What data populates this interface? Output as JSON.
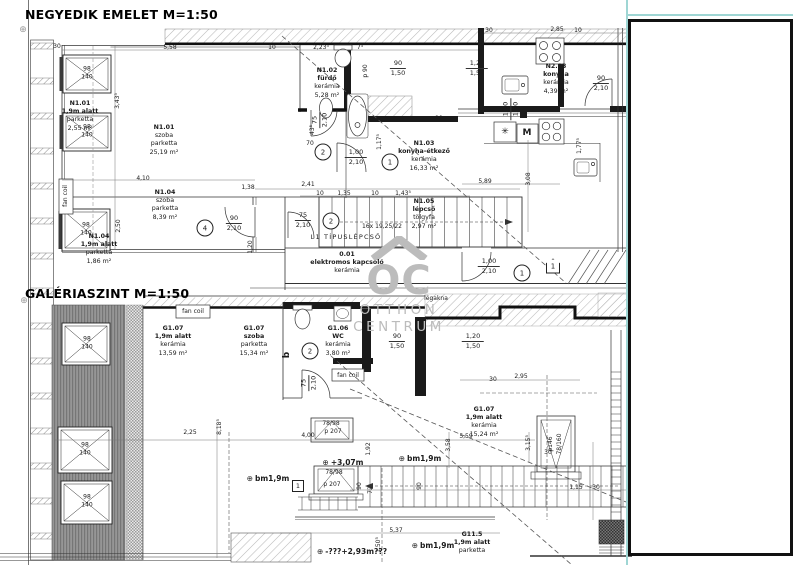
{
  "titles": {
    "upper": "NEGYEDIK EMELET M=1:50",
    "lower": "GALÉRIASZINT M=1:50"
  },
  "watermark": {
    "monogram": "OC",
    "line1": "OTTHON",
    "line2": "CENTRUM"
  },
  "colors": {
    "teal": "#9fd6d4",
    "line": "#1b1b1b",
    "watermark": "#bcbcbc"
  },
  "room_labels": [
    {
      "id": "N1.01",
      "sub": [
        "1,9m alatt",
        "parketta",
        "2,55 m²"
      ],
      "x": 80,
      "y": 100,
      "em": 1
    },
    {
      "id": "N1.01",
      "sub": [
        "szoba",
        "parketta",
        "25,19 m²"
      ],
      "x": 164,
      "y": 124
    },
    {
      "id": "N1.04",
      "sub": [
        "szoba",
        "parketta",
        "8,39 m²"
      ],
      "x": 165,
      "y": 189
    },
    {
      "id": "N1.04",
      "sub": [
        "1,9m alatt",
        "parketta",
        "1,86 m²"
      ],
      "x": 99,
      "y": 233,
      "em": 1
    },
    {
      "id": "N1.02",
      "sub": [
        "fürdő",
        "kerámia",
        "5,28 m²"
      ],
      "x": 327,
      "y": 67,
      "em": 1
    },
    {
      "id": "N1.03",
      "sub": [
        "konyha-étkező",
        "kerámia",
        "16,33 m²"
      ],
      "x": 424,
      "y": 140,
      "em": 1
    },
    {
      "id": "N2.03",
      "sub": [
        "konyha",
        "kerámia",
        "4,39 m²"
      ],
      "x": 556,
      "y": 63,
      "em": 1
    },
    {
      "id": "N1.05",
      "sub": [
        "lépcső",
        "tölgyfa",
        "2,97 m²"
      ],
      "x": 424,
      "y": 198,
      "em": 1
    },
    {
      "id": "0.01",
      "sub": [
        "elektromos kapcsoló",
        "kerámia"
      ],
      "x": 347,
      "y": 251,
      "em": 1
    },
    {
      "id": "G1.07",
      "sub": [
        "1,9m alatt",
        "kerámia",
        "13,59 m²"
      ],
      "x": 173,
      "y": 325,
      "em": 1
    },
    {
      "id": "G1.07",
      "sub": [
        "szoba",
        "parketta",
        "15,34 m²"
      ],
      "x": 254,
      "y": 325,
      "em": 1
    },
    {
      "id": "G1.06",
      "sub": [
        "WC",
        "kerámia",
        "3,80 m²"
      ],
      "x": 338,
      "y": 325,
      "em": 1
    },
    {
      "id": "G1.07",
      "sub": [
        "1,9m alatt",
        "kerámia",
        "15,24 m²"
      ],
      "x": 484,
      "y": 406,
      "em": 1
    },
    {
      "id": "G11.5",
      "sub": [
        "1,9m alatt",
        "parketta"
      ],
      "x": 472,
      "y": 531,
      "em": 1
    }
  ],
  "fractions": [
    {
      "top": "90",
      "bottom": "1,50",
      "x": 398,
      "y": 60
    },
    {
      "top": "1,20",
      "bottom": "1,50",
      "x": 477,
      "y": 60
    },
    {
      "top": "90",
      "bottom": "2,10",
      "x": 601,
      "y": 75
    },
    {
      "top": "90",
      "bottom": "2,10",
      "x": 234,
      "y": 215
    },
    {
      "top": "75",
      "bottom": "2,10",
      "x": 303,
      "y": 212
    },
    {
      "top": "1,00",
      "bottom": "2,10",
      "x": 356,
      "y": 149
    },
    {
      "top": "1,00",
      "bottom": "2,10",
      "x": 489,
      "y": 258
    },
    {
      "top": "90",
      "bottom": "1,50",
      "x": 397,
      "y": 333
    },
    {
      "top": "1,20",
      "bottom": "1,50",
      "x": 473,
      "y": 333
    },
    {
      "top": "75",
      "bottom": "2,10",
      "x": 309,
      "y": 383,
      "rot": 1
    },
    {
      "top": "75",
      "bottom": "2,10",
      "x": 320,
      "y": 120,
      "rot": 1
    },
    {
      "top": "1,20",
      "bottom": "1,50",
      "x": 511,
      "y": 109,
      "rot": 1
    }
  ],
  "texts": [
    {
      "t": "30",
      "x": 57,
      "y": 44
    },
    {
      "t": "5,58",
      "x": 170,
      "y": 45
    },
    {
      "t": "10",
      "x": 272,
      "y": 45
    },
    {
      "t": "2,23⁵",
      "x": 321,
      "y": 45
    },
    {
      "t": "7⁵",
      "x": 360,
      "y": 45
    },
    {
      "t": "30",
      "x": 489,
      "y": 28
    },
    {
      "t": "2,85",
      "x": 557,
      "y": 27
    },
    {
      "t": "10",
      "x": 578,
      "y": 28
    },
    {
      "t": "3,43⁵",
      "x": 118,
      "y": 101,
      "rot": 1
    },
    {
      "t": "2,50",
      "x": 119,
      "y": 226,
      "rot": 1
    },
    {
      "t": "4,10",
      "x": 143,
      "y": 176
    },
    {
      "t": "1,38",
      "x": 248,
      "y": 185
    },
    {
      "t": "2,41",
      "x": 308,
      "y": 182
    },
    {
      "t": "10",
      "x": 320,
      "y": 191
    },
    {
      "t": "1,35",
      "x": 344,
      "y": 191
    },
    {
      "t": "10",
      "x": 375,
      "y": 191
    },
    {
      "t": "1,43⁵",
      "x": 403,
      "y": 191
    },
    {
      "t": "5,89",
      "x": 485,
      "y": 179
    },
    {
      "t": "3,08",
      "x": 529,
      "y": 179,
      "rot": 1
    },
    {
      "t": "70",
      "x": 310,
      "y": 141
    },
    {
      "t": "43⁵",
      "x": 313,
      "y": 130,
      "rot": 1
    },
    {
      "t": "1,17⁵",
      "x": 380,
      "y": 142,
      "rot": 1
    },
    {
      "t": "1,77⁵",
      "x": 580,
      "y": 146,
      "rot": 1
    },
    {
      "t": "1,20",
      "x": 251,
      "y": 247,
      "rot": 1
    },
    {
      "t": "p 90",
      "x": 366,
      "y": 71,
      "rot": 1
    },
    {
      "t": "p 90",
      "x": 436,
      "y": 116
    },
    {
      "t": "16x 19,25/22",
      "x": 382,
      "y": 224
    },
    {
      "t": "L1 TÍPUSLÉPCSŐ",
      "x": 346,
      "y": 234,
      "cls": "sp"
    },
    {
      "t": "légakna",
      "x": 436,
      "y": 296
    },
    {
      "t": "fan coil",
      "x": 66,
      "y": 196,
      "rot": 1
    },
    {
      "t": "fan coil",
      "x": 193,
      "y": 309
    },
    {
      "t": "fan coil",
      "x": 348,
      "y": 373
    },
    {
      "t": "p 90",
      "x": 367,
      "y": 343,
      "rot": 1
    },
    {
      "t": "2,25",
      "x": 190,
      "y": 430
    },
    {
      "t": "8,18⁵",
      "x": 220,
      "y": 427,
      "rot": 1
    },
    {
      "t": "4,00",
      "x": 308,
      "y": 433
    },
    {
      "t": "1,92",
      "x": 369,
      "y": 449,
      "rot": 1
    },
    {
      "t": "78/98",
      "x": 331,
      "y": 421
    },
    {
      "t": "p 207",
      "x": 333,
      "y": 429
    },
    {
      "t": "78/98",
      "x": 334,
      "y": 470
    },
    {
      "t": "p 207",
      "x": 332,
      "y": 482
    },
    {
      "t": "p146",
      "x": 551,
      "y": 444,
      "rot": 1
    },
    {
      "t": "78/160",
      "x": 560,
      "y": 444,
      "rot": 1
    },
    {
      "t": "2,95",
      "x": 521,
      "y": 374
    },
    {
      "t": "30",
      "x": 493,
      "y": 377
    },
    {
      "t": "3,58",
      "x": 449,
      "y": 445,
      "rot": 1
    },
    {
      "t": "3,15⁵",
      "x": 529,
      "y": 443,
      "rot": 1
    },
    {
      "t": "5,59",
      "x": 466,
      "y": 434
    },
    {
      "t": "30",
      "x": 548,
      "y": 450
    },
    {
      "t": "1,15",
      "x": 576,
      "y": 485
    },
    {
      "t": "30",
      "x": 596,
      "y": 485
    },
    {
      "t": "90",
      "x": 360,
      "y": 486,
      "rot": 1
    },
    {
      "t": "72",
      "x": 371,
      "y": 490,
      "rot": 1
    },
    {
      "t": "90",
      "x": 420,
      "y": 486,
      "rot": 1
    },
    {
      "t": "5,37",
      "x": 396,
      "y": 528
    },
    {
      "t": "1,50⁵",
      "x": 379,
      "y": 545,
      "rot": 1
    },
    {
      "t": "+3,07m",
      "x": 343,
      "y": 459,
      "sym": "⊕",
      "cls": "lvl"
    },
    {
      "t": "bm1,9m",
      "x": 420,
      "y": 455,
      "sym": "⊕",
      "cls": "lvl"
    },
    {
      "t": "bm1,9m",
      "x": 268,
      "y": 475,
      "sym": "⊕",
      "cls": "lvl"
    },
    {
      "t": "bm1,9m",
      "x": 433,
      "y": 542,
      "sym": "⊕",
      "cls": "lvl"
    },
    {
      "t": "-???+2,93m???",
      "x": 352,
      "y": 548,
      "sym": "⊕",
      "cls": "lvl"
    },
    {
      "t": "⊕",
      "x": 23,
      "y": 26,
      "cls": "axis"
    },
    {
      "t": "⊕",
      "x": 24,
      "y": 297,
      "cls": "axis"
    }
  ],
  "wtags": [
    {
      "a": "98",
      "b": "140",
      "x": 87,
      "y": 73
    },
    {
      "a": "98",
      "b": "140",
      "x": 87,
      "y": 131
    },
    {
      "a": "98",
      "b": "140",
      "x": 86,
      "y": 229
    },
    {
      "a": "98",
      "b": "140",
      "x": 87,
      "y": 343
    },
    {
      "a": "98",
      "b": "140",
      "x": 85,
      "y": 449
    },
    {
      "a": "98",
      "b": "140",
      "x": 87,
      "y": 501
    }
  ],
  "markers": [
    {
      "t": "2",
      "s": "c",
      "x": 323,
      "y": 152
    },
    {
      "t": "1",
      "s": "c",
      "x": 390,
      "y": 162
    },
    {
      "t": "4",
      "s": "c",
      "x": 205,
      "y": 228
    },
    {
      "t": "2",
      "s": "c",
      "x": 331,
      "y": 221
    },
    {
      "t": "1",
      "s": "c",
      "x": 522,
      "y": 273
    },
    {
      "t": "2",
      "s": "c",
      "x": 310,
      "y": 351
    },
    {
      "t": "1",
      "s": "p",
      "x": 553,
      "y": 266
    },
    {
      "t": "1",
      "s": "q",
      "x": 298,
      "y": 486
    },
    {
      "t": "b",
      "s": "t",
      "x": 287,
      "y": 355,
      "rot": 1
    },
    {
      "t": "M",
      "s": "t",
      "x": 527,
      "y": 133
    },
    {
      "t": "✳",
      "s": "t",
      "x": 505,
      "y": 132
    }
  ]
}
